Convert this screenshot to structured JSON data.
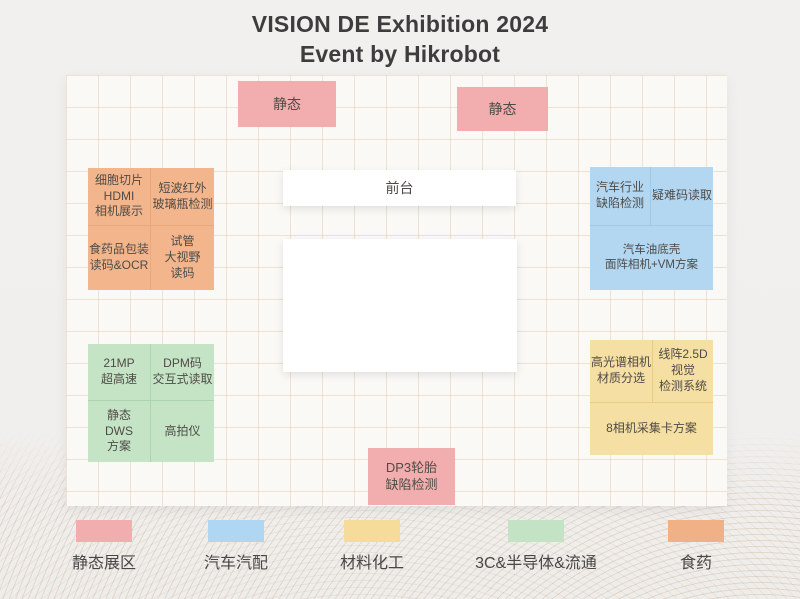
{
  "page": {
    "title_line1": "VISION DE Exhibition 2024",
    "title_line2": "Event by Hikrobot"
  },
  "zones": {
    "static_top_left": "静态",
    "static_top_right": "静态",
    "front_desk": "前台",
    "pharma": {
      "cell1": "细胞切片\nHDMI\n相机展示",
      "cell2": "短波红外\n玻璃瓶检测",
      "cell3": "食药品包装\n读码&OCR",
      "cell4": "试管\n大视野\n读码"
    },
    "automotive": {
      "cell1": "汽车行业\n缺陷检测",
      "cell2": "疑难码读取",
      "cell3": "汽车油底壳\n面阵相机+VM方案"
    },
    "semiconductor": {
      "cell1": "21MP\n超高速",
      "cell2": "DPM码\n交互式读取",
      "cell3": "静态\nDWS\n方案",
      "cell4": "高拍仪"
    },
    "material": {
      "cell1": "高光谱相机\n材质分选",
      "cell2": "线阵2.5D\n视觉\n检测系统",
      "cell3": "8相机采集卡方案"
    },
    "tire": "DP3轮胎\n缺陷检测"
  },
  "legend": {
    "items": [
      {
        "label": "静态展区",
        "color": "#F2AEAE"
      },
      {
        "label": "汽车汽配",
        "color": "#AFD6F2"
      },
      {
        "label": "材料化工",
        "color": "#F5DC9A"
      },
      {
        "label": "3C&半导体&流通",
        "color": "#C3E3C4"
      },
      {
        "label": "食药",
        "color": "#EFB185"
      }
    ]
  },
  "colors": {
    "static_pink": "#F2AEAE",
    "pharma_orange": "#F3B68C",
    "automotive_blue": "#B3D7F1",
    "semiconductor_green": "#C5E4C5",
    "material_yellow": "#F6DFA2",
    "grid_line": "#DEBC98",
    "title_text": "#3D3D3D"
  }
}
